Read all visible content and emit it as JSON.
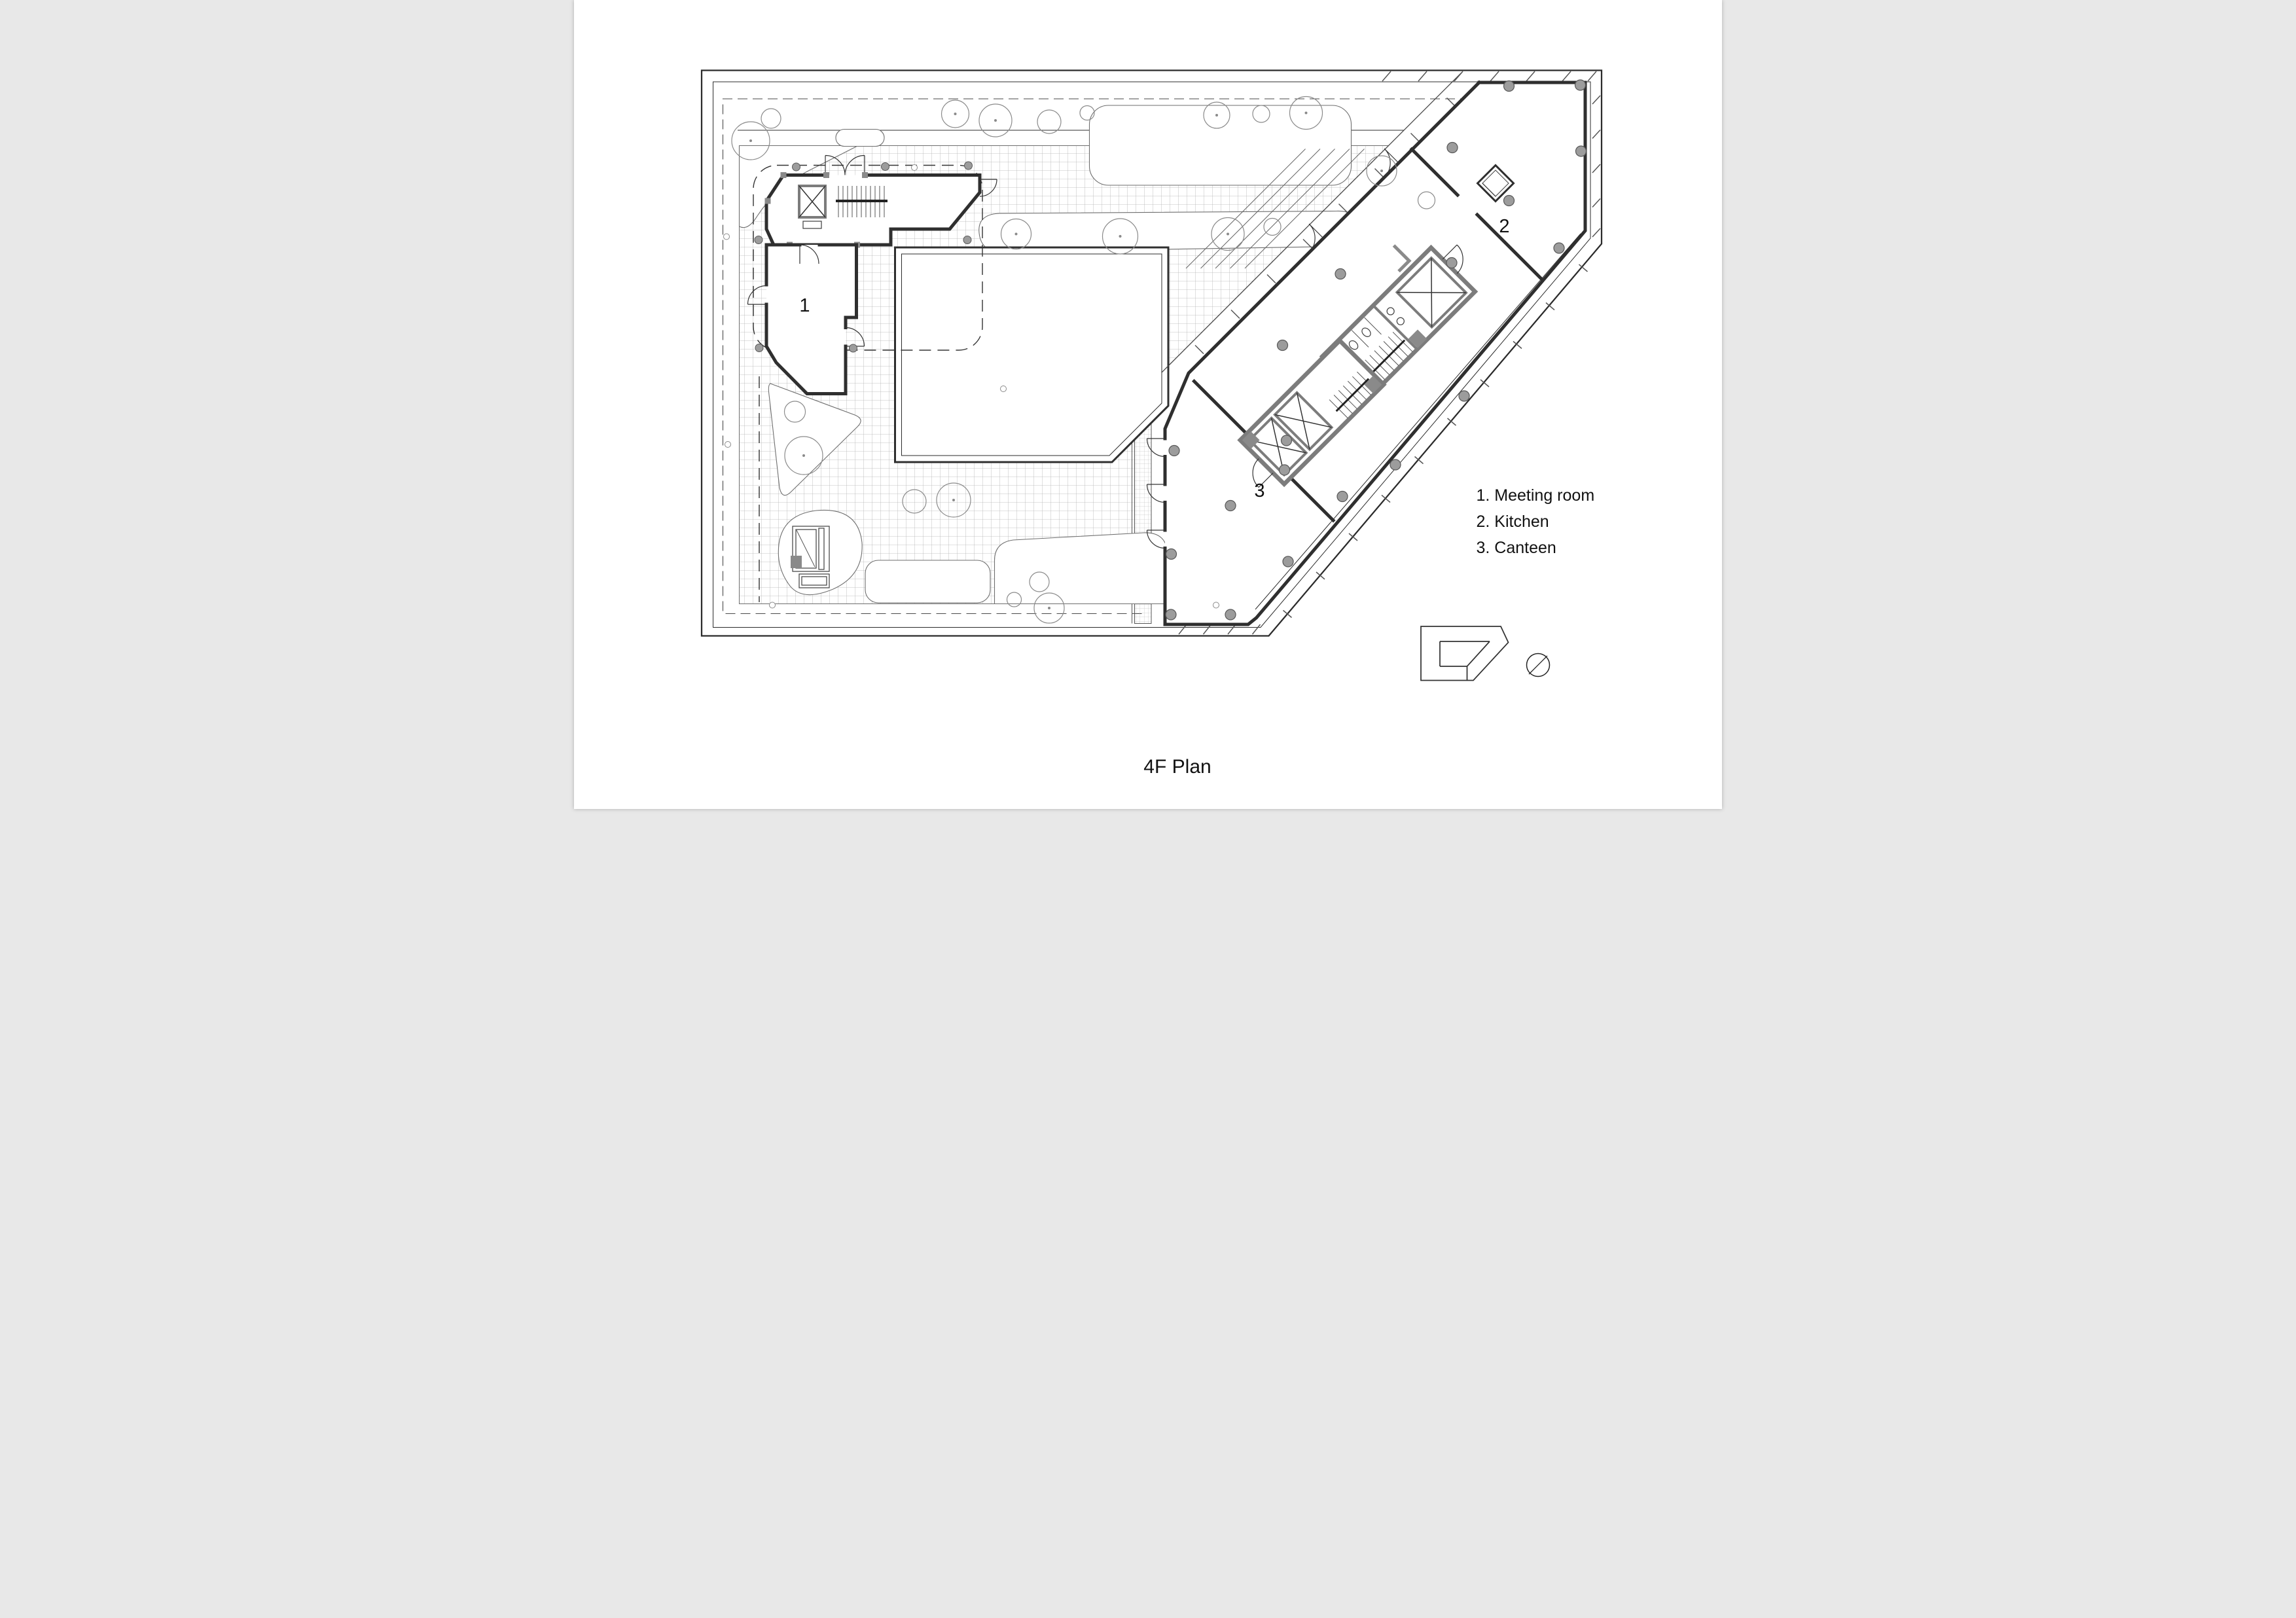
{
  "drawing": {
    "type": "architectural floor plan",
    "floor": "4F"
  },
  "title": {
    "text": "4F Plan"
  },
  "legend": {
    "items": [
      {
        "text": "1. Meeting room"
      },
      {
        "text": "2. Kitchen"
      },
      {
        "text": "3. Canteen"
      }
    ]
  },
  "plan": {
    "rooms": [
      {
        "number": "1",
        "name": "Meeting room"
      },
      {
        "number": "2",
        "name": "Kitchen"
      },
      {
        "number": "3",
        "name": "Canteen"
      }
    ]
  },
  "icons": {
    "key_plan": "key-plan-footprint-icon",
    "north_arrow": "north-arrow-icon"
  },
  "colors": {
    "paper": "#ffffff",
    "ink": "#222222",
    "wall": "#2f2f2f",
    "core_wall": "#7c7c7c",
    "poche": "#8a8a8a",
    "grid_line": "#b3b3b3",
    "column_fill": "#9c9c9c",
    "tree": "#8a8a8a"
  }
}
